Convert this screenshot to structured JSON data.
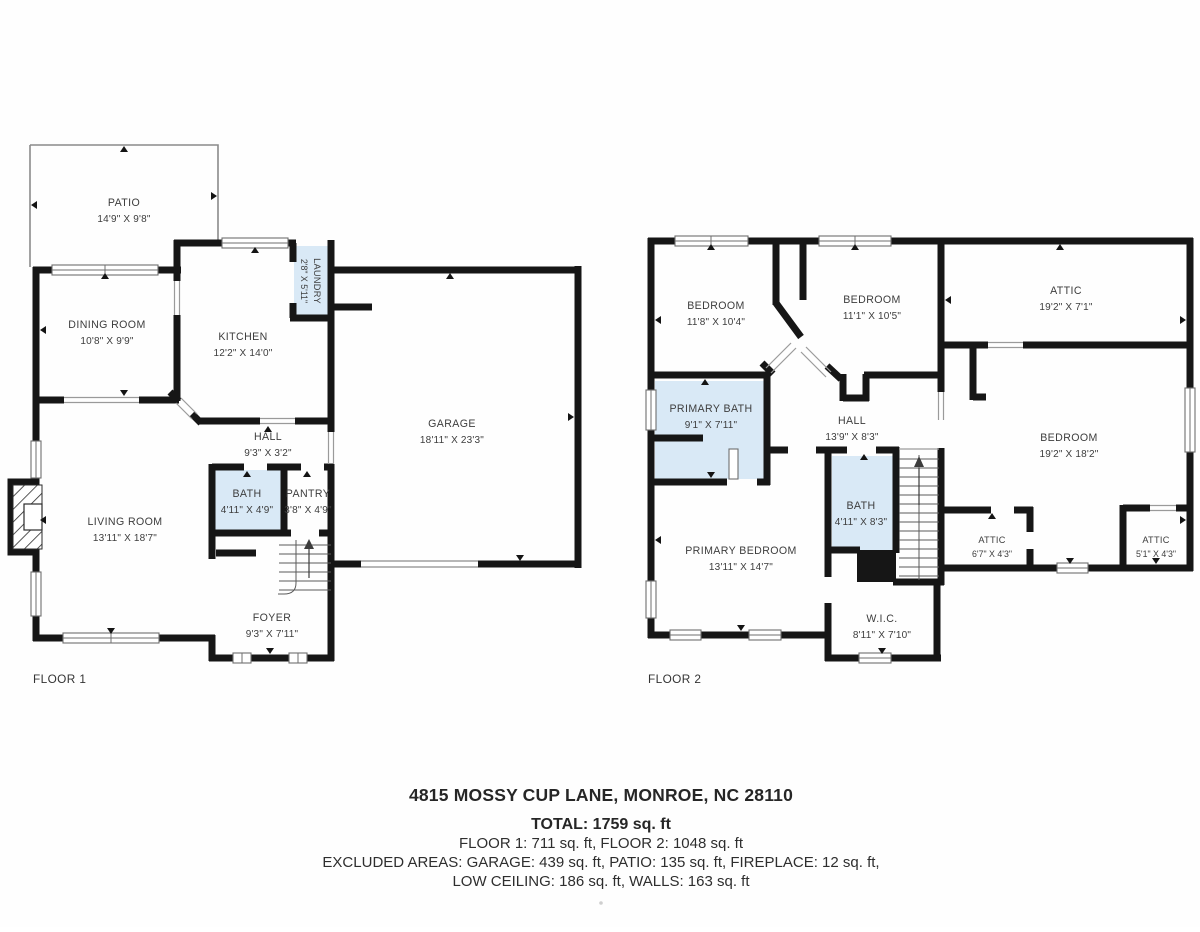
{
  "colors": {
    "wall": "#161616",
    "room_highlight": "#d9e9f6",
    "background": "#fefefe",
    "label_text": "#3d3d3d"
  },
  "floor1": {
    "label": "FLOOR 1",
    "rooms": [
      {
        "name": "PATIO",
        "dims": "14'9\" X 9'8\""
      },
      {
        "name": "DINING ROOM",
        "dims": "10'8\" X 9'9\""
      },
      {
        "name": "KITCHEN",
        "dims": "12'2\" X 14'0\""
      },
      {
        "name": "LAUNDRY",
        "dims": "2'8\" X 5'11\""
      },
      {
        "name": "GARAGE",
        "dims": "18'11\" X 23'3\""
      },
      {
        "name": "HALL",
        "dims": "9'3\" X 3'2\""
      },
      {
        "name": "BATH",
        "dims": "4'11\" X 4'9\""
      },
      {
        "name": "PANTRY",
        "dims": "3'8\" X 4'9\""
      },
      {
        "name": "LIVING ROOM",
        "dims": "13'11\" X 18'7\""
      },
      {
        "name": "FOYER",
        "dims": "9'3\" X 7'11\""
      }
    ]
  },
  "floor2": {
    "label": "FLOOR 2",
    "rooms": [
      {
        "name": "BEDROOM",
        "dims": "11'8\" X 10'4\""
      },
      {
        "name": "BEDROOM",
        "dims": "11'1\" X 10'5\""
      },
      {
        "name": "ATTIC",
        "dims": "19'2\" X 7'1\""
      },
      {
        "name": "PRIMARY BATH",
        "dims": "9'1\" X 7'11\""
      },
      {
        "name": "HALL",
        "dims": "13'9\" X 8'3\""
      },
      {
        "name": "BEDROOM",
        "dims": "19'2\" X 18'2\""
      },
      {
        "name": "BATH",
        "dims": "4'11\" X 8'3\""
      },
      {
        "name": "PRIMARY BEDROOM",
        "dims": "13'11\" X 14'7\""
      },
      {
        "name": "W.I.C.",
        "dims": "8'11\" X 7'10\""
      },
      {
        "name": "ATTIC",
        "dims": "6'7\" X 4'3\""
      },
      {
        "name": "ATTIC",
        "dims": "5'1\" X 4'3\""
      }
    ]
  },
  "summary": {
    "address": "4815 MOSSY CUP LANE, MONROE, NC 28110",
    "total": "TOTAL: 1759 sq. ft",
    "floors": "FLOOR 1: 711 sq. ft, FLOOR 2: 1048 sq. ft",
    "excluded_line1": "EXCLUDED AREAS: GARAGE: 439 sq. ft, PATIO: 135 sq. ft, FIREPLACE: 12 sq. ft,",
    "excluded_line2": "LOW CEILING: 186 sq. ft, WALLS: 163 sq. ft"
  }
}
